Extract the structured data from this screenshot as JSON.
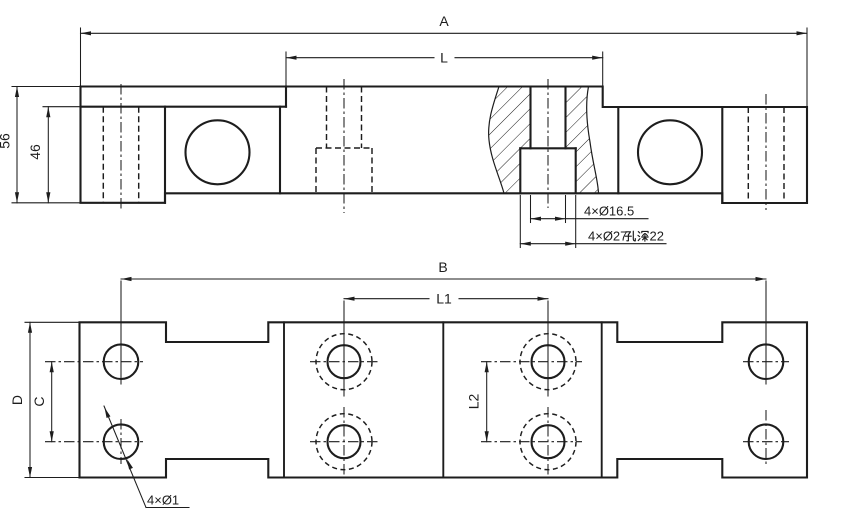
{
  "page": {
    "background": "#ffffff",
    "line_color": "#1d1d1d",
    "kind": "engineering-drawing",
    "views_count": 2
  },
  "views": {
    "side": {
      "dim_overall_length": "A",
      "dim_beam_length": "L",
      "dim_overall_height": "56",
      "dim_block_height": "46",
      "ann_through_hole": "4×Ø16.5",
      "ann_counterbore_full": "4×Ø27孔深22",
      "ann_counterbore_prefix": "4×Ø27",
      "ann_counterbore_cjk": "孔深",
      "ann_counterbore_suffix": "22"
    },
    "plan": {
      "dim_hole_span": "B",
      "dim_inner_span": "L1",
      "dim_inner_pitch": "L2",
      "dim_hole_pitch": "C",
      "dim_width": "D",
      "ann_corner_holes": "4×Ø1"
    }
  }
}
